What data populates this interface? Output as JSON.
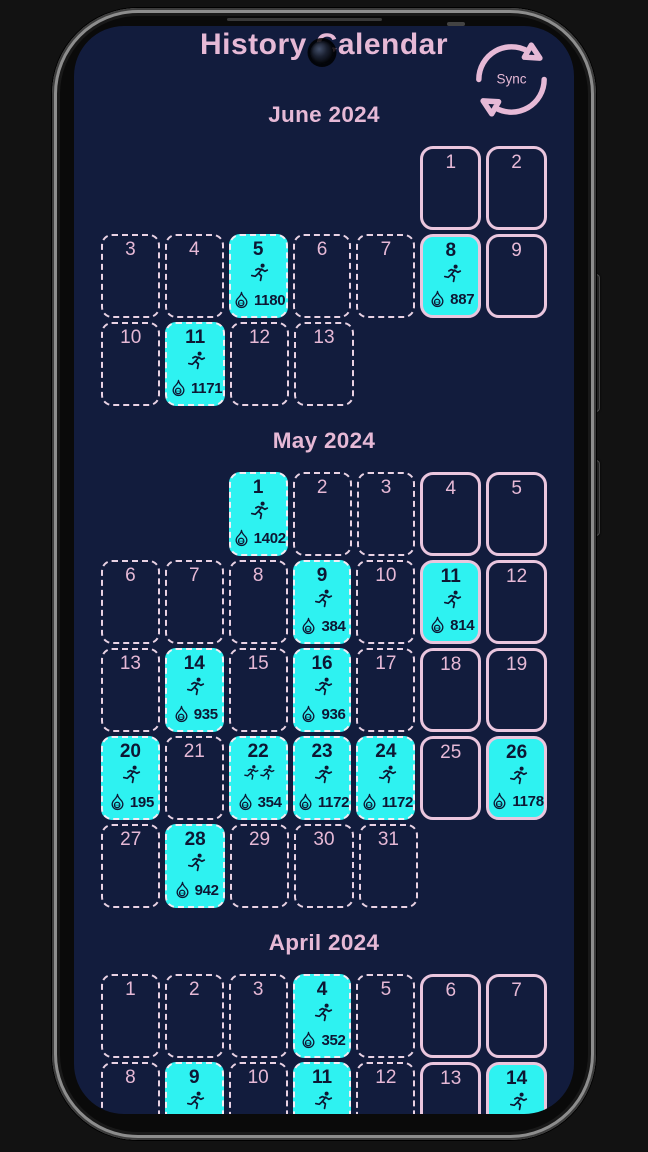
{
  "app": {
    "title": "History Calendar",
    "sync_label": "Sync"
  },
  "icons": {
    "sync": "sync-arrows-icon",
    "activity": "runner-icon",
    "calories": "flame-kcal-icon",
    "flame_inner_text": "kcal"
  },
  "theme": {
    "screen_bg": "#121c3d",
    "outer_bg": "#121212",
    "active_bg": "#2ef2f1",
    "pink_text": "#e6b9d6",
    "weekend_border": "#eac6de",
    "dashed_border": "#e9d2e4",
    "dark_text": "#0d1733"
  },
  "months": [
    {
      "name": "June 2024",
      "weeks": [
        [
          null,
          null,
          null,
          null,
          null,
          {
            "day": 1,
            "weekend": true
          },
          {
            "day": 2,
            "weekend": true
          }
        ],
        [
          {
            "day": 3
          },
          {
            "day": 4
          },
          {
            "day": 5,
            "active": true,
            "runs": 1,
            "kcal": "1180"
          },
          {
            "day": 6
          },
          {
            "day": 7
          },
          {
            "day": 8,
            "weekend": true,
            "active": true,
            "runs": 1,
            "kcal": "887"
          },
          {
            "day": 9,
            "weekend": true
          }
        ],
        [
          {
            "day": 10
          },
          {
            "day": 11,
            "active": true,
            "runs": 1,
            "kcal": "1171"
          },
          {
            "day": 12
          },
          {
            "day": 13
          },
          null,
          null,
          null
        ]
      ]
    },
    {
      "name": "May 2024",
      "weeks": [
        [
          null,
          null,
          {
            "day": 1,
            "active": true,
            "runs": 1,
            "kcal": "1402"
          },
          {
            "day": 2
          },
          {
            "day": 3
          },
          {
            "day": 4,
            "weekend": true
          },
          {
            "day": 5,
            "weekend": true
          }
        ],
        [
          {
            "day": 6
          },
          {
            "day": 7
          },
          {
            "day": 8
          },
          {
            "day": 9,
            "active": true,
            "runs": 1,
            "kcal": "384"
          },
          {
            "day": 10
          },
          {
            "day": 11,
            "weekend": true,
            "active": true,
            "runs": 1,
            "kcal": "814"
          },
          {
            "day": 12,
            "weekend": true
          }
        ],
        [
          {
            "day": 13
          },
          {
            "day": 14,
            "active": true,
            "runs": 1,
            "kcal": "935"
          },
          {
            "day": 15
          },
          {
            "day": 16,
            "active": true,
            "runs": 1,
            "kcal": "936"
          },
          {
            "day": 17
          },
          {
            "day": 18,
            "weekend": true
          },
          {
            "day": 19,
            "weekend": true
          }
        ],
        [
          {
            "day": 20,
            "active": true,
            "runs": 1,
            "kcal": "195"
          },
          {
            "day": 21
          },
          {
            "day": 22,
            "active": true,
            "runs": 2,
            "kcal": "354"
          },
          {
            "day": 23,
            "active": true,
            "runs": 1,
            "kcal": "1172"
          },
          {
            "day": 24,
            "active": true,
            "runs": 1,
            "kcal": "1172"
          },
          {
            "day": 25,
            "weekend": true
          },
          {
            "day": 26,
            "weekend": true,
            "active": true,
            "runs": 1,
            "kcal": "1178"
          }
        ],
        [
          {
            "day": 27
          },
          {
            "day": 28,
            "active": true,
            "runs": 1,
            "kcal": "942"
          },
          {
            "day": 29
          },
          {
            "day": 30
          },
          {
            "day": 31
          },
          null,
          null
        ]
      ]
    },
    {
      "name": "April 2024",
      "weeks": [
        [
          {
            "day": 1
          },
          {
            "day": 2
          },
          {
            "day": 3
          },
          {
            "day": 4,
            "active": true,
            "runs": 1,
            "kcal": "352"
          },
          {
            "day": 5
          },
          {
            "day": 6,
            "weekend": true
          },
          {
            "day": 7,
            "weekend": true
          }
        ],
        [
          {
            "day": 8
          },
          {
            "day": 9,
            "active": true,
            "runs": 1
          },
          {
            "day": 10
          },
          {
            "day": 11,
            "active": true,
            "runs": 1
          },
          {
            "day": 12
          },
          {
            "day": 13,
            "weekend": true
          },
          {
            "day": 14,
            "weekend": true,
            "active": true,
            "runs": 1
          }
        ]
      ]
    }
  ]
}
